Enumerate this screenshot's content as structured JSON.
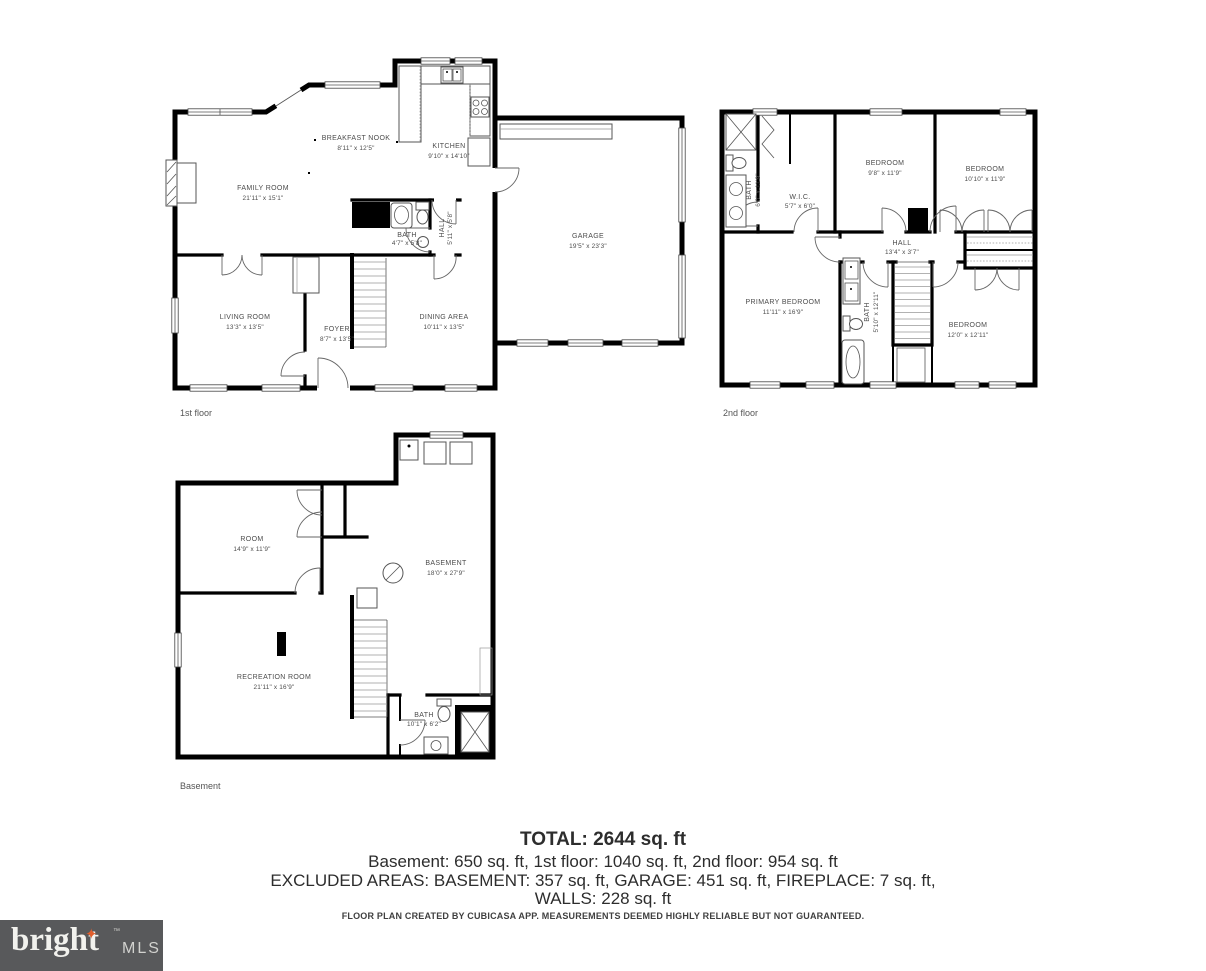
{
  "floors": {
    "first": {
      "label": "1st floor",
      "rooms": {
        "family": {
          "name": "FAMILY ROOM",
          "dims": "21'11\" x 15'1\""
        },
        "nook": {
          "name": "BREAKFAST NOOK",
          "dims": "8'11\" x 12'5\""
        },
        "kitchen": {
          "name": "KITCHEN",
          "dims": "9'10\" x 14'10\""
        },
        "bath": {
          "name": "BATH",
          "dims": "4'7\" x 5'8\""
        },
        "hall": {
          "name": "HALL",
          "dims": "5'11\" x 5'8\""
        },
        "garage": {
          "name": "GARAGE",
          "dims": "19'5\" x 23'3\""
        },
        "living": {
          "name": "LIVING ROOM",
          "dims": "13'3\" x 13'5\""
        },
        "foyer": {
          "name": "FOYER",
          "dims": "8'7\" x 13'5\""
        },
        "dining": {
          "name": "DINING AREA",
          "dims": "10'11\" x 13'5\""
        }
      }
    },
    "second": {
      "label": "2nd floor",
      "rooms": {
        "bath1": {
          "name": "BATH",
          "dims": "6'0\" x 11'9\""
        },
        "wic": {
          "name": "W.I.C.",
          "dims": "5'7\" x 6'0\""
        },
        "bed1": {
          "name": "BEDROOM",
          "dims": "9'8\" x 11'9\""
        },
        "bed2": {
          "name": "BEDROOM",
          "dims": "10'10\" x 11'9\""
        },
        "hall": {
          "name": "HALL",
          "dims": "13'4\" x 3'7\""
        },
        "primary": {
          "name": "PRIMARY BEDROOM",
          "dims": "11'11\" x 16'9\""
        },
        "bath2": {
          "name": "BATH",
          "dims": "5'10\" x 12'11\""
        },
        "bed3": {
          "name": "BEDROOM",
          "dims": "12'0\" x 12'11\""
        }
      }
    },
    "basement": {
      "label": "Basement",
      "rooms": {
        "room": {
          "name": "ROOM",
          "dims": "14'9\" x 11'9\""
        },
        "basement": {
          "name": "BASEMENT",
          "dims": "18'0\" x 27'9\""
        },
        "rec": {
          "name": "RECREATION ROOM",
          "dims": "21'11\" x 16'9\""
        },
        "bath": {
          "name": "BATH",
          "dims": "10'1\" x 6'2\""
        }
      }
    }
  },
  "summary": {
    "total": "TOTAL: 2644 sq. ft",
    "floors_line": "Basement: 650 sq. ft, 1st floor: 1040 sq. ft, 2nd floor: 954 sq. ft",
    "excluded_line": "EXCLUDED AREAS: BASEMENT: 357 sq. ft, GARAGE: 451 sq. ft, FIREPLACE: 7 sq. ft,",
    "walls_line": "WALLS: 228 sq. ft"
  },
  "disclaimer": "FLOOR PLAN CREATED BY CUBICASA APP. MEASUREMENTS DEEMED HIGHLY RELIABLE BUT NOT GUARANTEED.",
  "logo": {
    "brand": "bright",
    "trademark": "™",
    "suffix": "MLS",
    "star_glyph": "✦",
    "colors": {
      "background": "#58595b",
      "brand_text": "#f2f2ee",
      "star": "#e05e2d",
      "suffix_text": "#d2d2cf",
      "walls": "#000000",
      "labels": "#4c4c4c"
    }
  }
}
